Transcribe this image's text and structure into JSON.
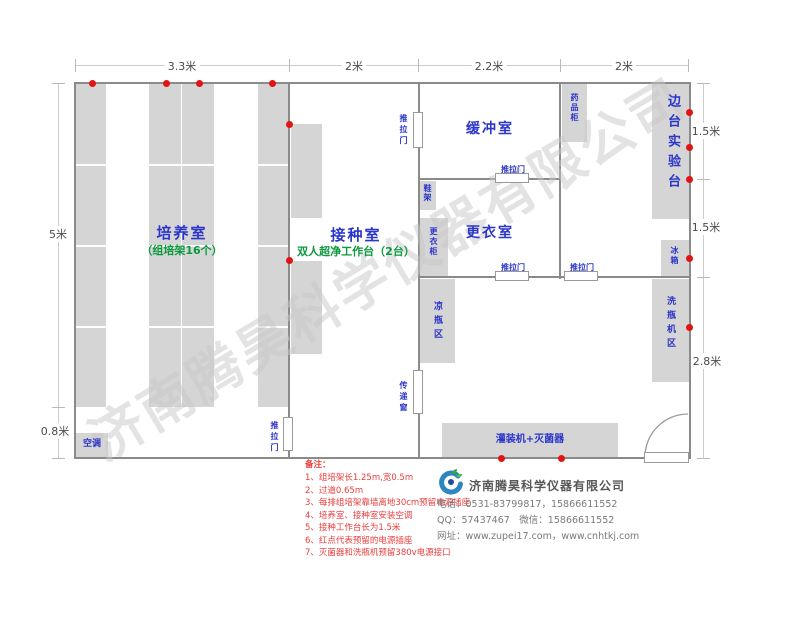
{
  "dimensions": {
    "top": [
      "3.3米",
      "2米",
      "2.2米",
      "2米"
    ],
    "left": [
      "5米",
      "0.8米"
    ],
    "right": [
      "1.5米",
      "1.5米",
      "2.8米"
    ]
  },
  "rooms": {
    "cultivation": {
      "name": "培养室",
      "subtitle": "（组培架16个）"
    },
    "inoculation": {
      "name": "接种室",
      "subtitle": "双人超净工作台（2台）"
    },
    "buffer": {
      "name": "缓冲室"
    },
    "changing": {
      "name": "更衣室"
    },
    "side_bench": {
      "name": "边台实验台"
    }
  },
  "labels": {
    "sliding_door": "推拉门",
    "shoe_rack": "鞋架",
    "wardrobe": "更衣柜",
    "medicine_cabinet": "药品柜",
    "fridge": "冰箱",
    "cooling_bottle_area": "凉瓶区",
    "transfer_window": "传递窗",
    "bottle_washer_area": "洗瓶机区",
    "air_conditioner": "空调",
    "filling_sterilizer": "灌装机+灭菌器"
  },
  "notes": {
    "title": "备注：",
    "items": [
      "1、组培架长1.25m,宽0.5m",
      "2、过道0.65m",
      "3、每排组培架靠墙离地30cm预留电源插座",
      "4、培养室、接种室安装空调",
      "5、接种工作台长为1.5米",
      "6、红点代表预留的电源插座",
      "7、灭菌器和洗瓶机预留380v电源接口"
    ]
  },
  "company": {
    "name": "济南腾昊科学仪器有限公司",
    "phone": "电话：0531-83799817，15866611552",
    "qq_wechat": "QQ：57437467　微信：15866611552",
    "website": "网址：www.zupei17.com，www.cnhtkj.com"
  },
  "watermark": "济南腾昊科学仪器有限公司",
  "colors": {
    "room_label_blue": "#2b35c9",
    "annotation_green": "#0a9a3d",
    "note_red": "#ee3b3b",
    "outlet_dot_red": "#e21313",
    "furniture_fill": "#d5d5d5",
    "wall_gray": "#8a8a8a"
  }
}
